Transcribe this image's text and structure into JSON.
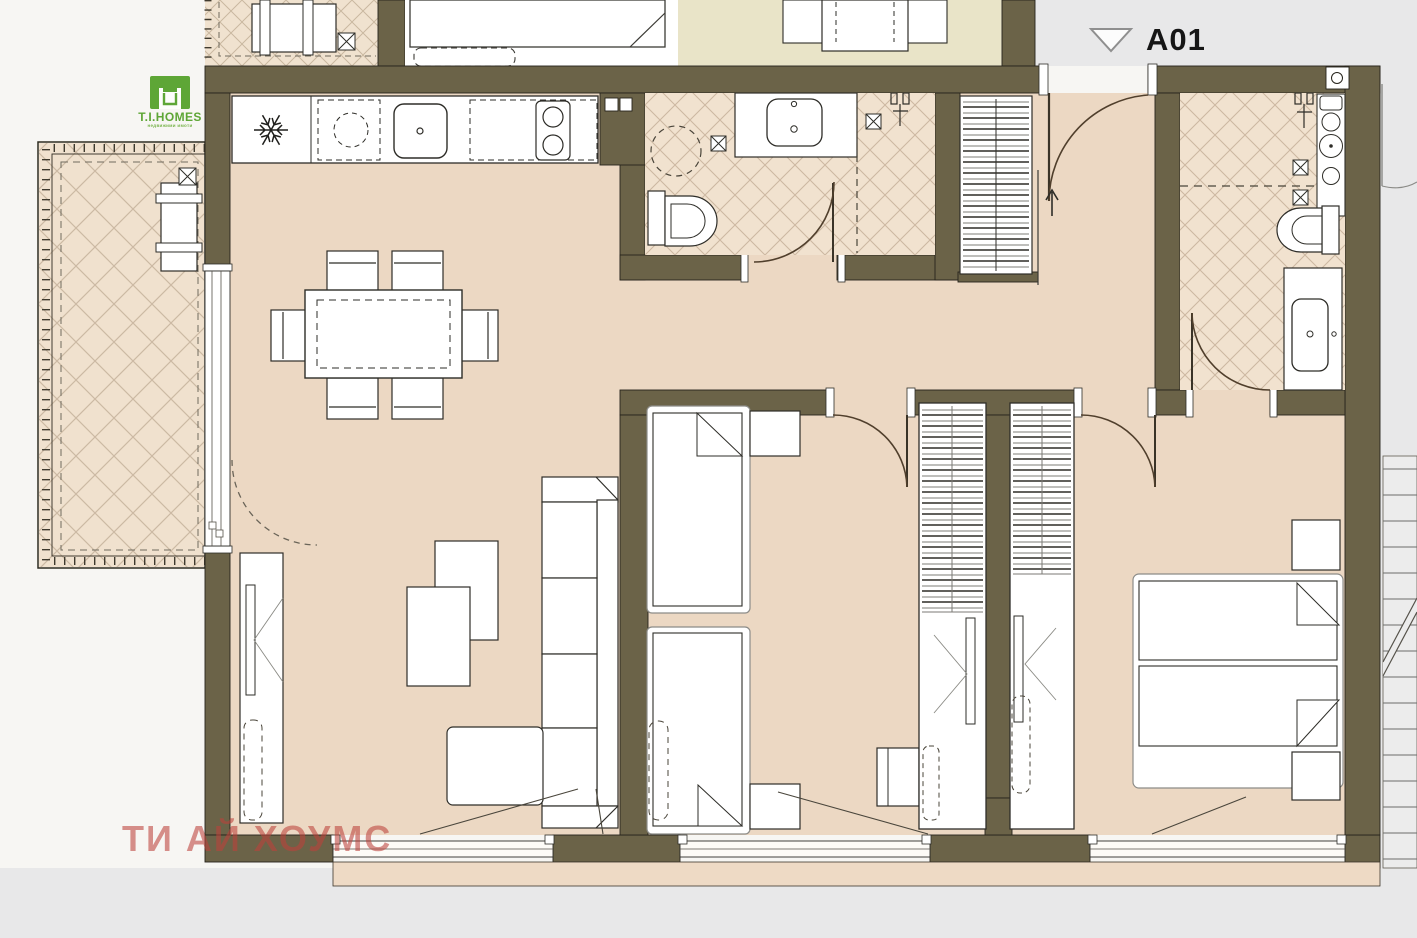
{
  "unit_label": {
    "marker_icon": "triangle-down",
    "text": "A01"
  },
  "branding": {
    "logo_text": "T.I.HOMES",
    "logo_tagline": "недвижими имоти",
    "logo_color": "#5ea636"
  },
  "watermark": {
    "text": "ТИ АЙ ХОУМС",
    "color": "#bc423a"
  },
  "palette": {
    "wall": "#6b6348",
    "floor": "#ecd8c3",
    "tile_floor": "#f1e2cf",
    "hatch_line": "#ccb8a2",
    "upper_apartment_floor": "#e9e4c8",
    "background": "#f7f6f3",
    "corridor_gray": "#e8e8e9",
    "furniture_outline": "#2e2d28",
    "stair_fill": "#ececec"
  },
  "icons": {
    "fridge": "snowflake",
    "floor_drain": "boxed-x",
    "entrance_direction": "arrow-up",
    "unit_marker": "triangle-down"
  }
}
